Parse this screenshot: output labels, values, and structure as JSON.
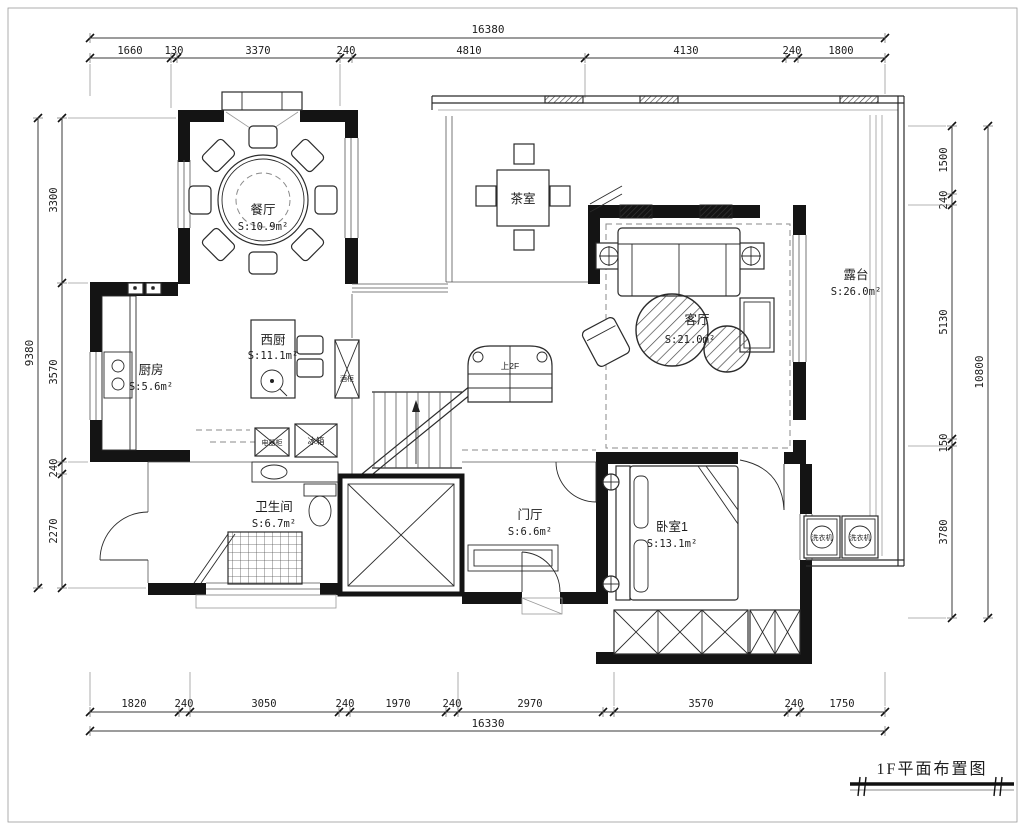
{
  "title": {
    "text": "1F平面布置图"
  },
  "dimensions": {
    "top": {
      "total": "16380",
      "segments": [
        "1660",
        "130",
        "3370",
        "240",
        "4810",
        "4130",
        "240",
        "1800"
      ]
    },
    "bottom": {
      "total": "16330",
      "segments": [
        "1820",
        "240",
        "3050",
        "240",
        "1970",
        "240",
        "2970",
        "3570",
        "240",
        "1750"
      ]
    },
    "left": {
      "total": "9380",
      "segments": [
        "3300",
        "3570",
        "240",
        "2270"
      ]
    },
    "right": {
      "total": "10800",
      "segments": [
        "1500",
        "240",
        "5130",
        "150",
        "3780"
      ]
    }
  },
  "rooms": {
    "dining": {
      "name": "餐厅",
      "area": "S:10.9m²"
    },
    "tea": {
      "name": "茶室",
      "area": ""
    },
    "west_kitchen": {
      "name": "西厨",
      "area": "S:11.1m²"
    },
    "kitchen": {
      "name": "厨房",
      "area": "S:5.6m²"
    },
    "living": {
      "name": "客厅",
      "area": "S:21.0m²"
    },
    "terrace": {
      "name": "露台",
      "area": "S:26.0m²"
    },
    "bathroom": {
      "name": "卫生间",
      "area": "S:6.7m²"
    },
    "foyer": {
      "name": "门厅",
      "area": "S:6.6m²"
    },
    "bedroom1": {
      "name": "卧室1",
      "area": "S:13.1m²"
    }
  },
  "labels": {
    "stairs_up": "上2F",
    "wine_cabinet": "酒柜",
    "appliance_cabinet": "电器柜",
    "fridge": "冰箱",
    "washer_left": "洗衣机",
    "washer_right": "洗衣机"
  },
  "colors": {
    "wall": "#141414",
    "line": "#2b2b2b",
    "background": "#ffffff"
  }
}
